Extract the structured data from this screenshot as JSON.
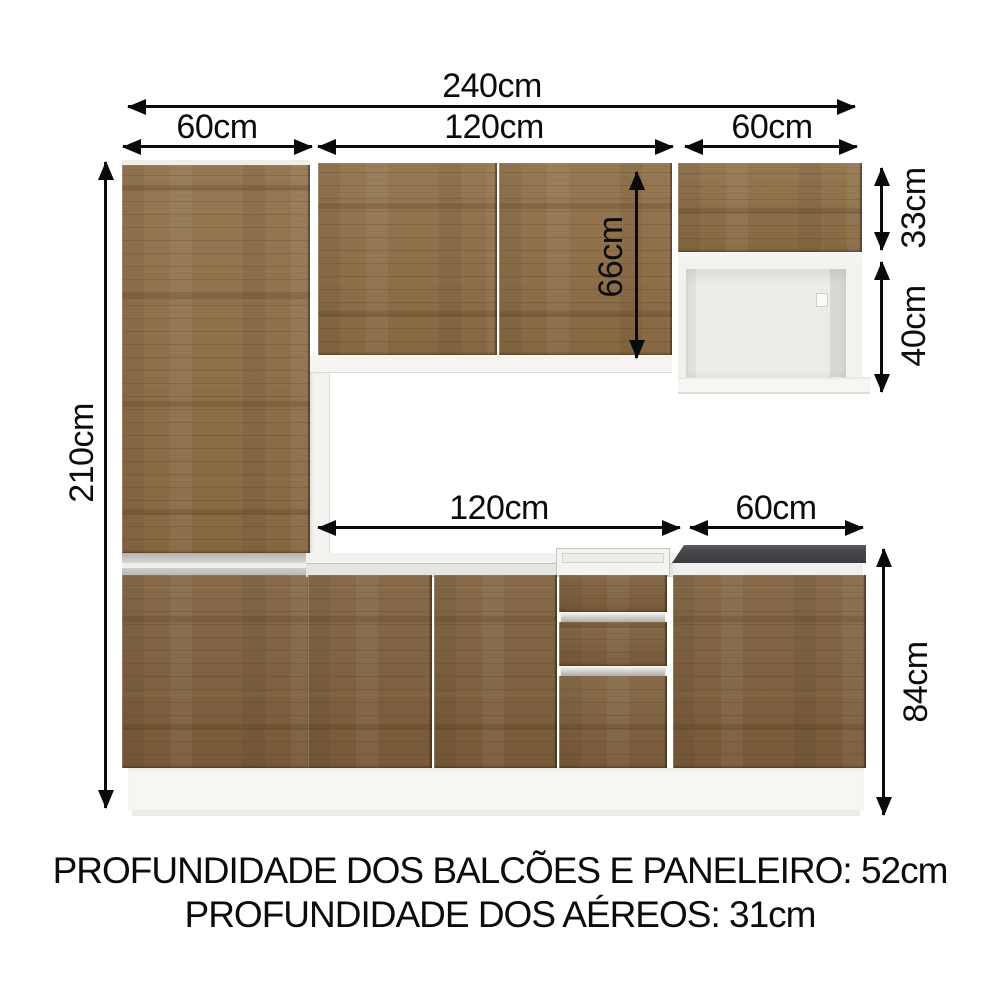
{
  "dimensions": {
    "total_width": "240cm",
    "tall_cabinet_width": "60cm",
    "upper_middle_width": "120cm",
    "upper_right_width": "60cm",
    "total_height": "210cm",
    "upper_cabinet_height": "66cm",
    "upper_right_door_height": "33cm",
    "niche_height": "40cm",
    "counter_middle_width": "120cm",
    "counter_right_width": "60cm",
    "base_height": "84cm"
  },
  "footnotes": [
    "PROFUNDIDADE DOS BALCÕES E PANELEIRO: 52cm",
    "PROFUNDIDADE DOS AÉREOS: 31cm"
  ],
  "colors": {
    "wood": "#8d6d45",
    "wood_dark": "#7d5e3b",
    "carcass_white": "#f4f3ef",
    "countertop_dark": "#454549",
    "silver_trim": "#c9c8c4",
    "dimension_line": "#0a0a0a"
  }
}
